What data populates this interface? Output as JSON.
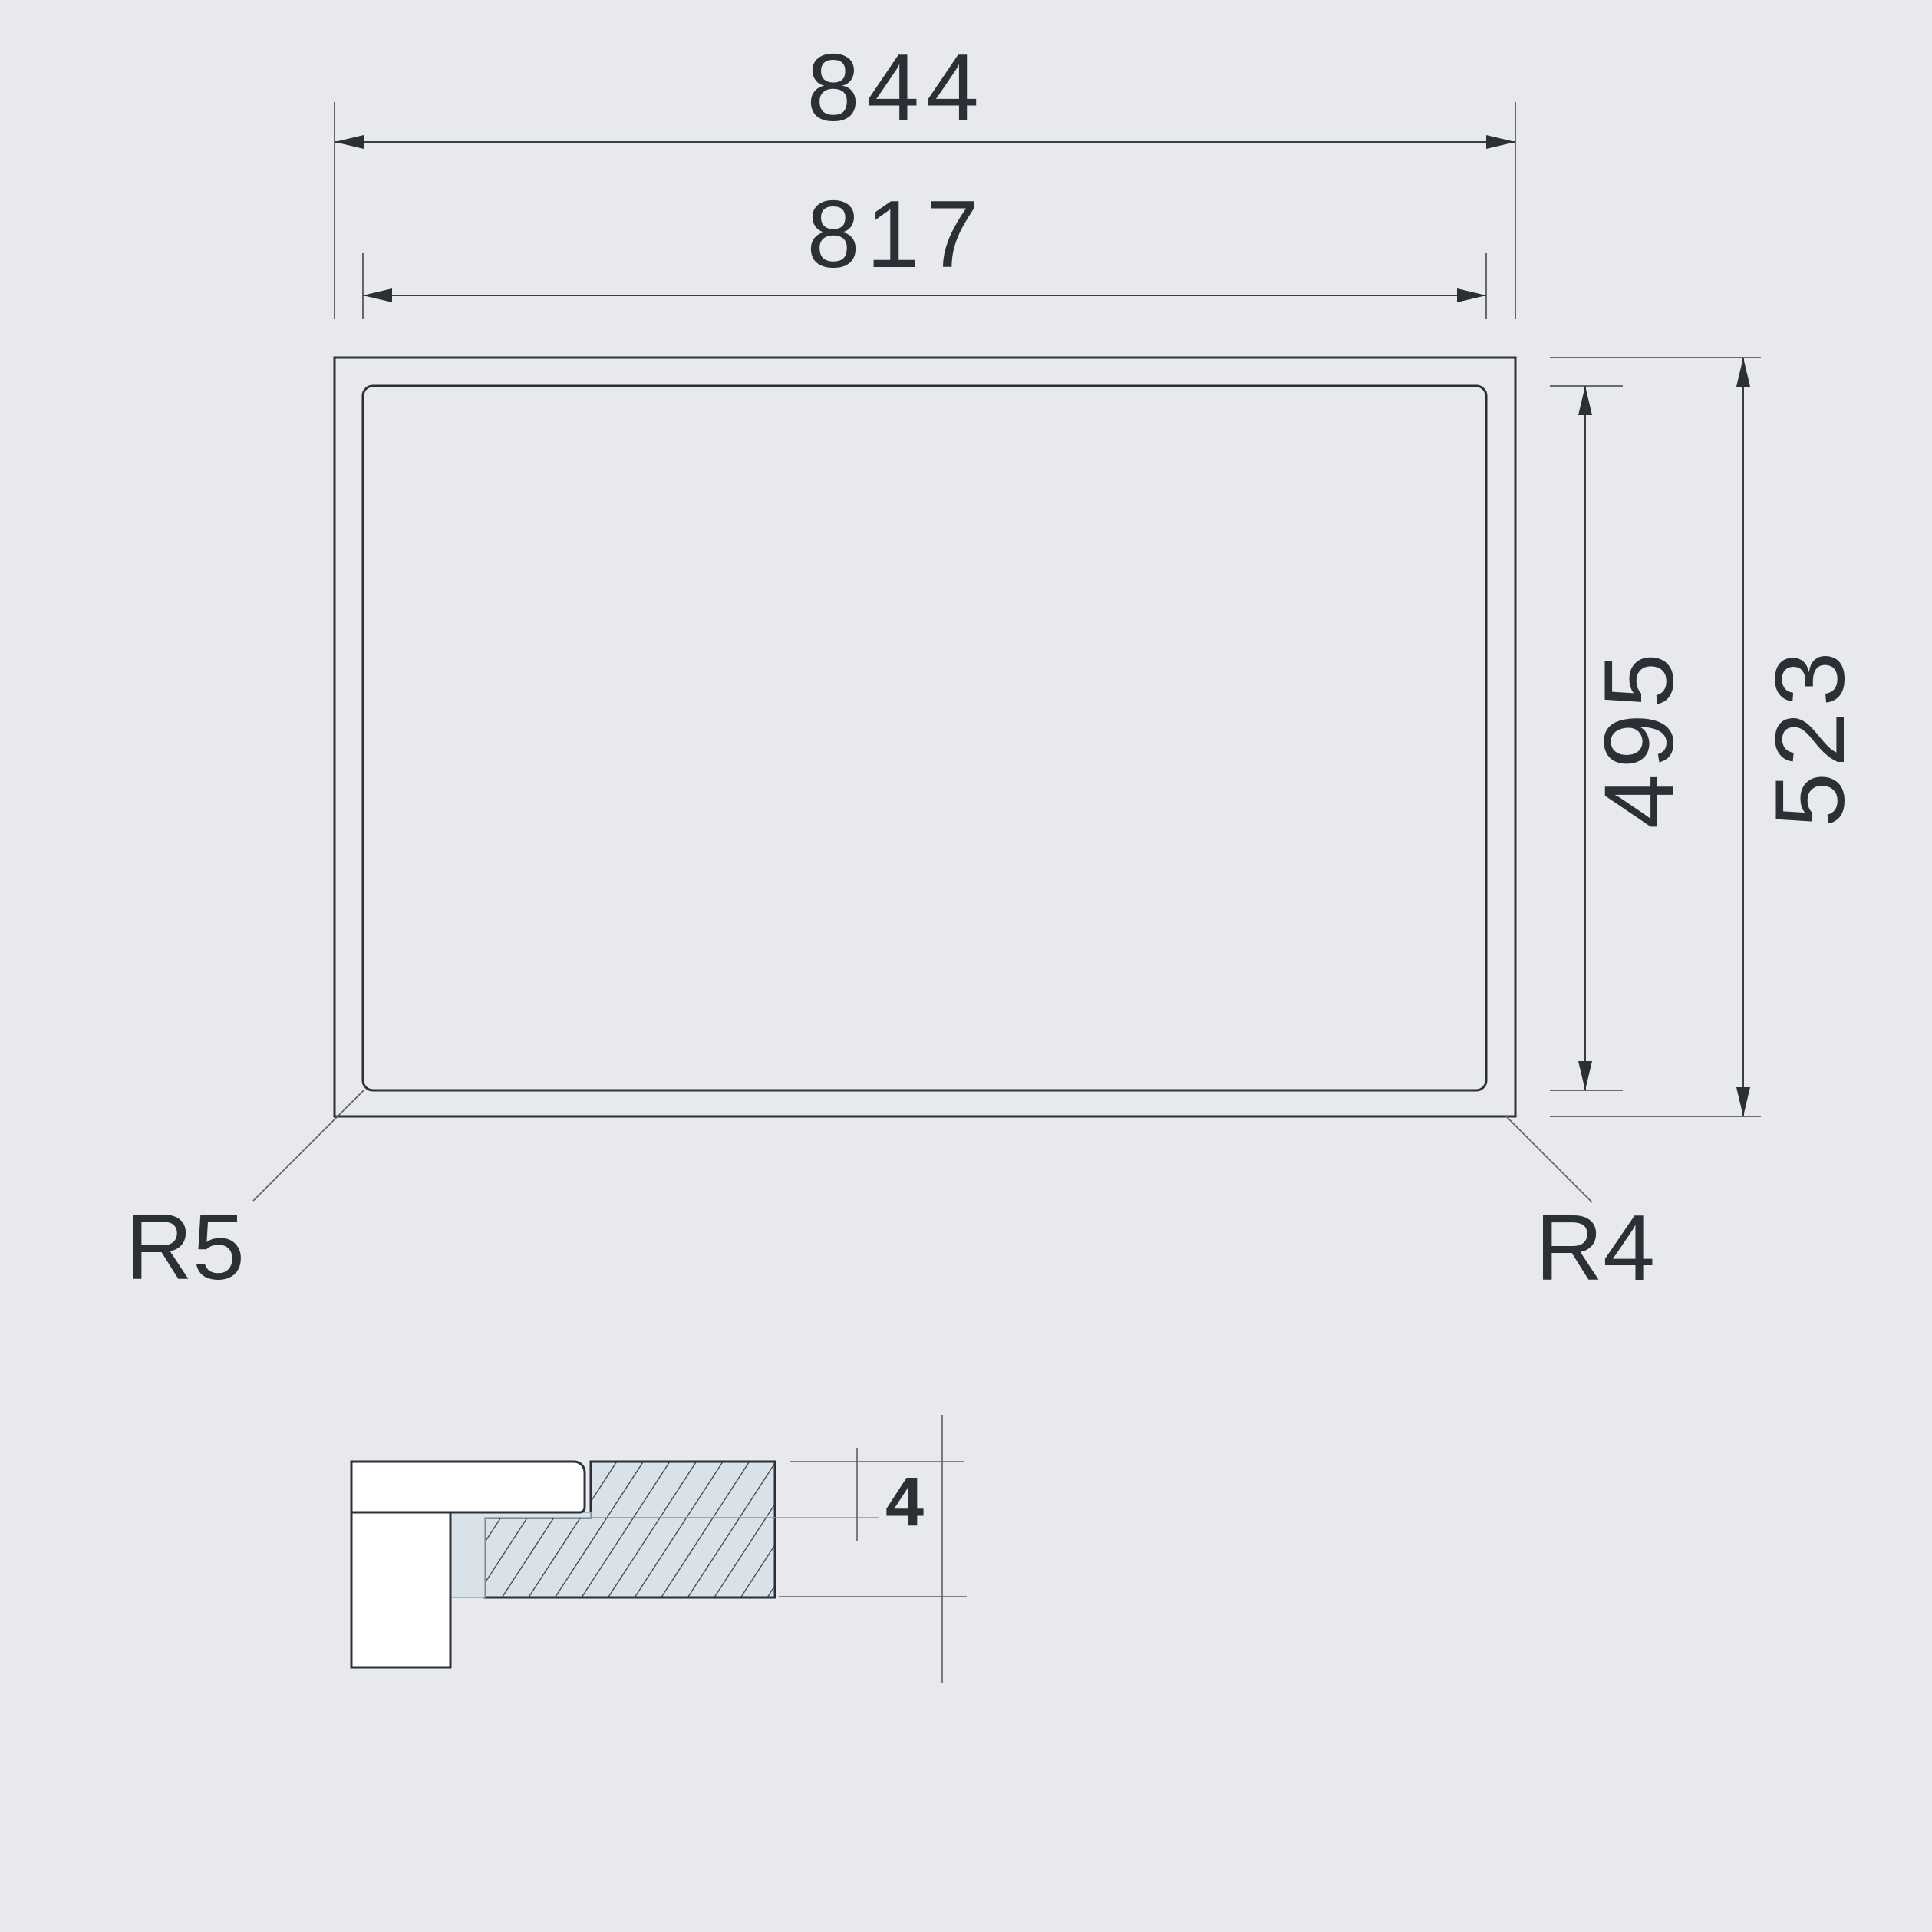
{
  "drawing": {
    "title": "appliance-cutout-installation-drawing",
    "plan": {
      "dim_outer_width": "844",
      "dim_inner_width": "817",
      "dim_inner_height": "495",
      "dim_outer_height": "523",
      "radius_label_bottom_left": "R5",
      "radius_label_bottom_right": "R4"
    },
    "section": {
      "dim_recess_depth": "4"
    },
    "colors": {
      "background": "#e7e9ed",
      "outline_dark": "#2b3036",
      "extension_gray": "#555a5f",
      "material_fill": "#d9e2e9",
      "hatch_line": "#343c44",
      "panel_white": "#ffffff"
    }
  }
}
